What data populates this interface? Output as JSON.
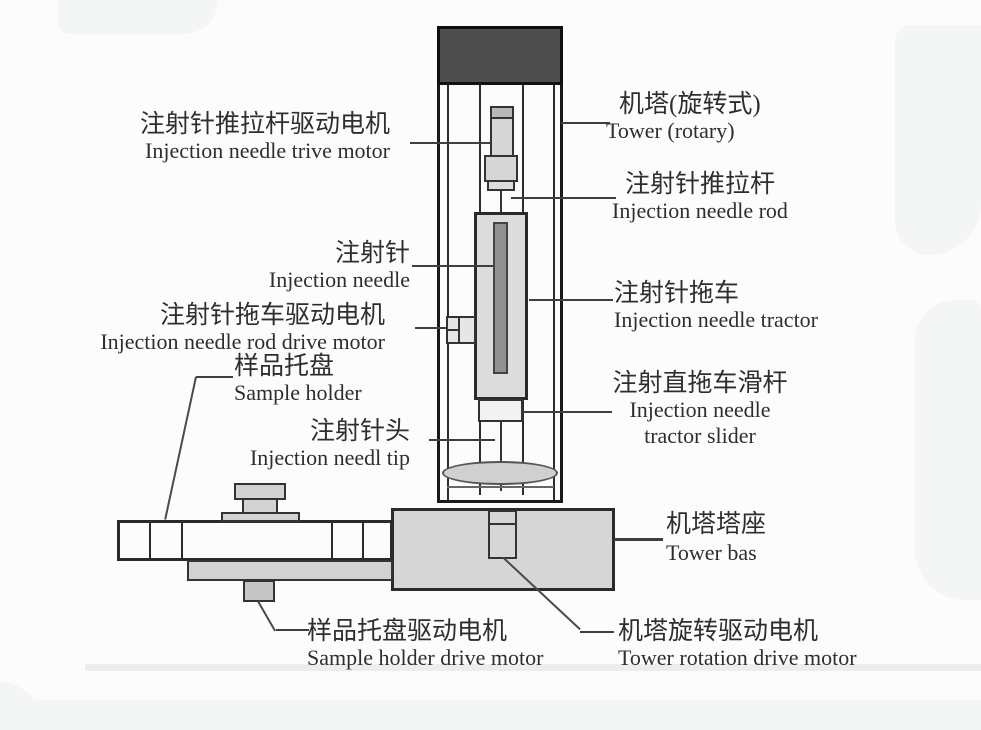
{
  "labels": {
    "needle_drive_motor": {
      "zh": "注射针推拉杆驱动电机",
      "en": "Injection needle trive motor"
    },
    "tower_rotary": {
      "zh": "机塔(旋转式)",
      "en": "Tower (rotary)"
    },
    "needle_rod": {
      "zh": "注射针推拉杆",
      "en": "Injection needle rod"
    },
    "needle": {
      "zh": "注射针",
      "en": "Injection needle"
    },
    "needle_tractor": {
      "zh": "注射针拖车",
      "en": "Injection needle tractor"
    },
    "rod_drive_motor": {
      "zh": "注射针拖车驱动电机",
      "en": "Injection needle rod drive motor"
    },
    "sample_holder": {
      "zh": "样品托盘",
      "en": "Sample holder"
    },
    "tractor_slider": {
      "zh": "注射直拖车滑杆",
      "en1": "Injection needle",
      "en2": "tractor slider"
    },
    "needle_tip": {
      "zh": "注射针头",
      "en": "Injection needl tip"
    },
    "tower_base": {
      "zh": "机塔塔座",
      "en": "Tower bas"
    },
    "sample_holder_drive_motor": {
      "zh": "样品托盘驱动电机",
      "en": "Sample holder drive motor"
    },
    "tower_rotation_drive_motor": {
      "zh": "机塔旋转驱动电机",
      "en": "Tower rotation drive motor"
    }
  },
  "colors": {
    "background": "#fcfcfc",
    "tower_cap": "#4e4e4e",
    "component_fill": "#d6d6d6",
    "needle_fill": "#909090",
    "outline": "#1a1a1a",
    "leader_line": "#3f3f3f",
    "text": "#2e2e2e"
  }
}
